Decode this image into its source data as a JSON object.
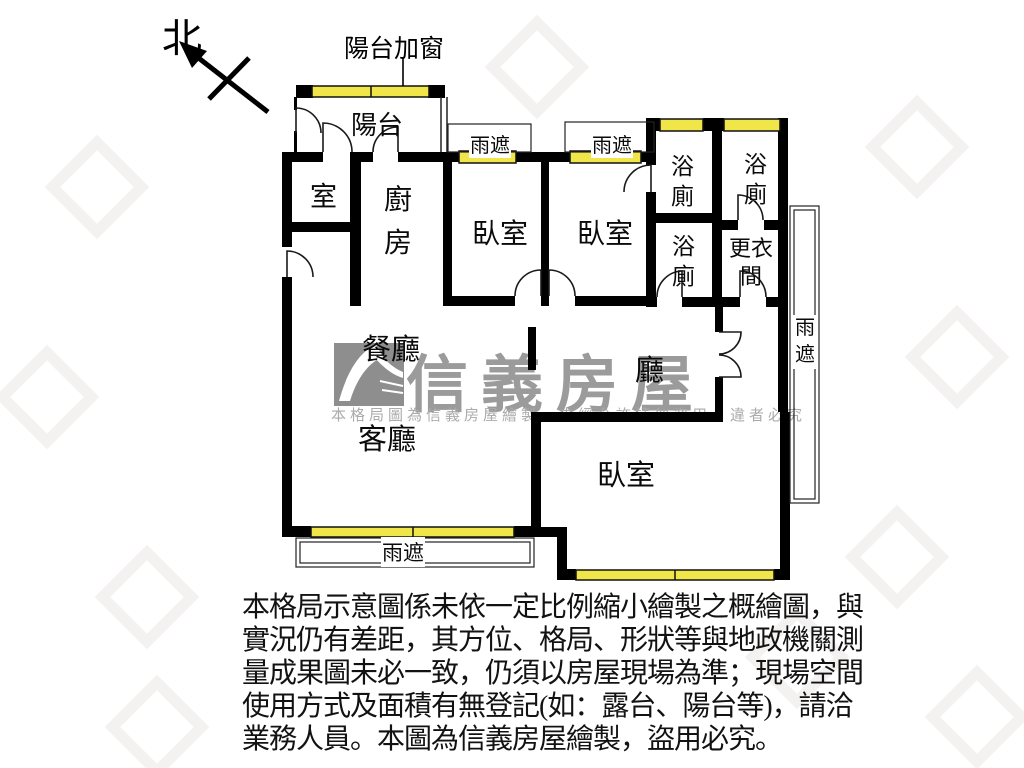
{
  "compass": {
    "label": "北"
  },
  "callout": {
    "balcony_window": "陽台加窗"
  },
  "rooms": {
    "balcony": "陽台",
    "room": "室",
    "kitchen": "廚房",
    "bedroom": "臥室",
    "bath": "浴廁",
    "dressing": "更衣間",
    "dining": "餐廳",
    "hall": "廳",
    "living": "客廳"
  },
  "canopy": {
    "label": "雨遮"
  },
  "watermark": {
    "brand": "信義房屋",
    "notice": "本格局圖為信義房屋繪製，未經允許請勿盜用，違者必究"
  },
  "disclaimer": {
    "lines": [
      "本格局示意圖係未依一定比例縮小繪製之概繪圖，與",
      "實況仍有差距，其方位、格局、形狀等與地政機關測",
      "量成果圖未必一致，仍須以房屋現場為準；現場空間",
      "使用方式及面積有無登記(如：露台、陽台等)，請洽",
      "業務人員。本圖為信義房屋繪製，盜用必究。"
    ]
  },
  "colors": {
    "wall": "#000000",
    "window": "#f0e64a",
    "watermark_grey": "#9b9b9b"
  }
}
